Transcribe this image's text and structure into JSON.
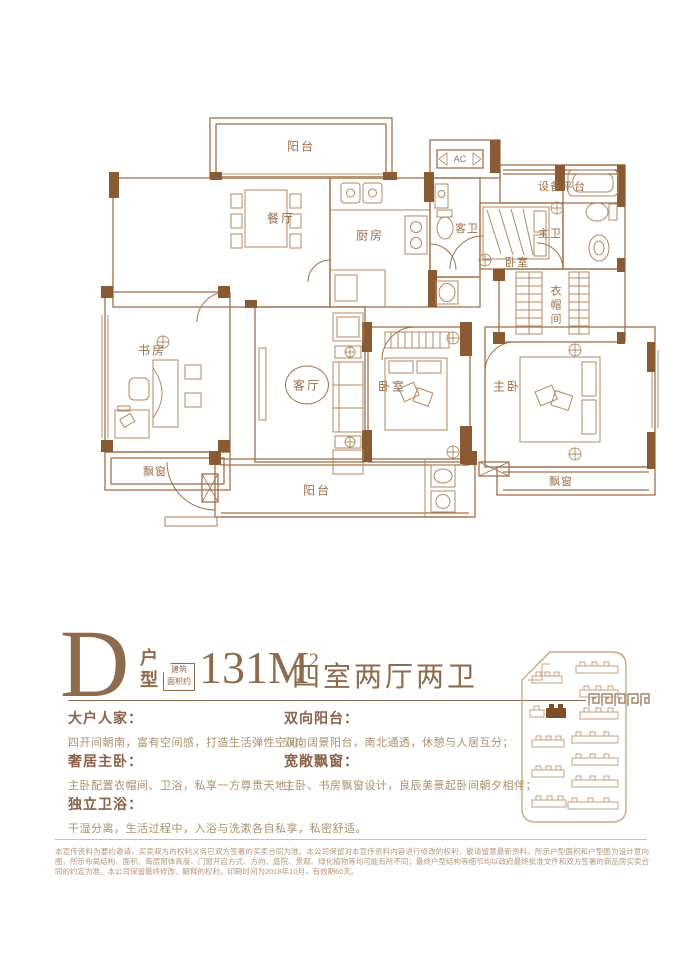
{
  "colors": {
    "wall": "#8a5a32",
    "line": "#a0714a",
    "furniture": "#b08a62",
    "brand": "#8d6b4c",
    "heading": "#8a6149",
    "body_text": "#a8906f",
    "disclaimer": "#b2967a",
    "highlight_building": "#7d4e28"
  },
  "floorplan": {
    "rooms": [
      "阳台",
      "餐厅",
      "厨房",
      "客卫",
      "设备平台",
      "卧室",
      "主卫",
      "衣帽间",
      "书房",
      "客厅",
      "卧室",
      "主卧",
      "飘窗",
      "飘窗",
      "阳台"
    ],
    "ac_label": "AC"
  },
  "title": {
    "letter": "D",
    "type_label": "户型",
    "area_tag_line1": "建筑",
    "area_tag_line2": "面积约",
    "area_value": "131M",
    "area_superscript": "2",
    "summary": "四室两厅两卫"
  },
  "features": [
    {
      "heading": "大户人家：",
      "body": "四开间朝南，富有空间感，打造生活弹性空间；"
    },
    {
      "heading": "双向阳台：",
      "body": "双向阔景阳台，南北通透，休憩与人居互分；"
    },
    {
      "heading": "奢居主卧：",
      "body": "主卧配置衣帽间、卫浴，私享一方尊贵天地；"
    },
    {
      "heading": "宽敞飘窗：",
      "body": "主卧、书房飘窗设计，良辰美景起卧间朝夕相伴；"
    },
    {
      "heading": "独立卫浴：",
      "body": "干湿分离，生活过程中，入浴与洗漱各自私享，私密舒适。"
    }
  ],
  "disclaimer": "本宣传资料为要约邀请，买卖双方的权利义务已双方签署的买卖合同为准。本公司保留对本宣传资料内容进行修改的权利，敬请留意最新资料。所示户型面积和户型图为设计意向图，所示布局结构、面积、每层窗体高度、门窗开启方式、方向、庭院、景观、绿化植物等均可能有所不同；最终户型结构等细节均以政府最终批准文件和双方签署的商品房买卖合同的约定为准。本公司保留最终修改、解释的权利，印刷时间为2018年10月，有效期60天。"
}
